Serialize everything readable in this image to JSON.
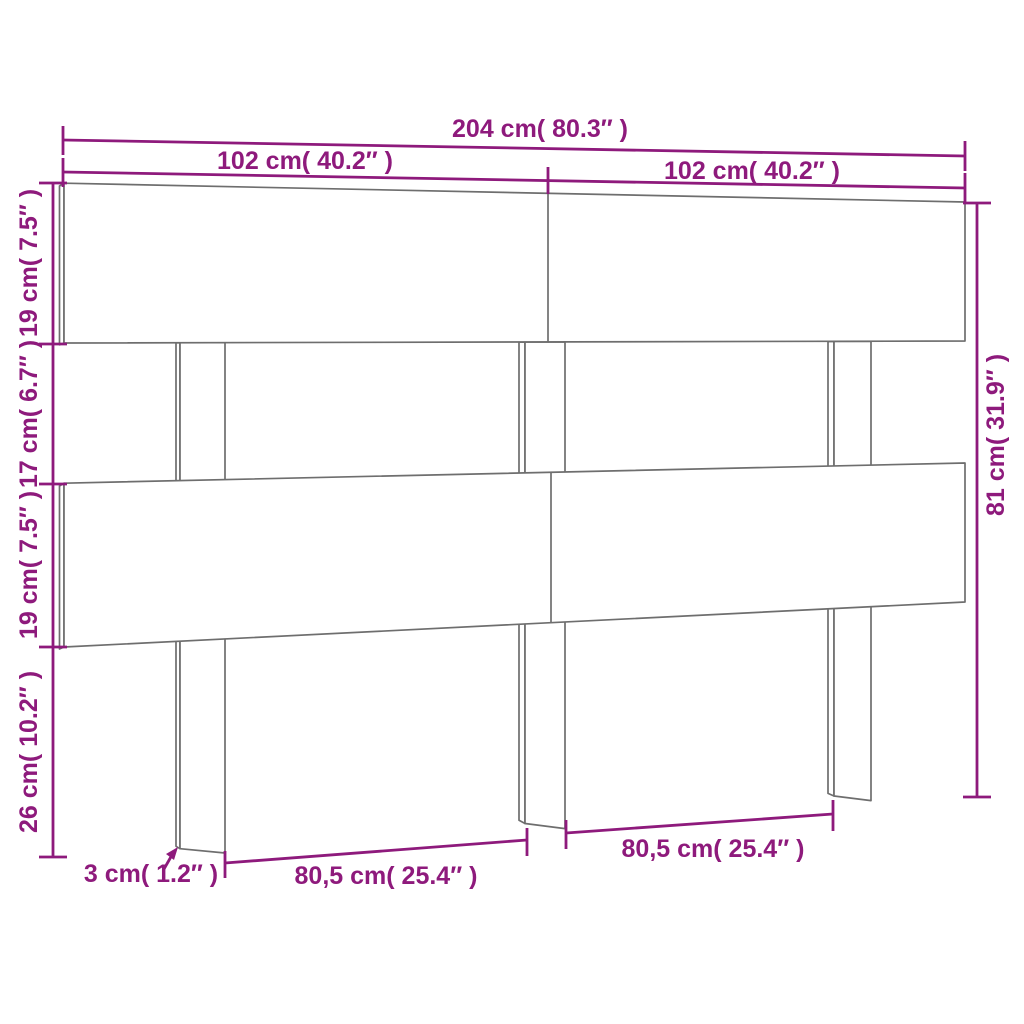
{
  "diagram": {
    "type": "product-dimension-diagram",
    "subject": "slatted headboard with three legs",
    "colors": {
      "dimension_annotation": "#8e1a7c",
      "product_outline": "#6e6e6e",
      "background": "#ffffff"
    },
    "labels": {
      "total_width": "204 cm( 80.3″ )",
      "left_half_width": "102 cm( 40.2″ )",
      "right_half_width": "102 cm( 40.2″ )",
      "top_board_height": "19 cm( 7.5″ )",
      "slat_gap_height": "17 cm( 6.7″ )",
      "lower_board_height": "19 cm( 7.5″ )",
      "leg_below_height": "26 cm( 10.2″ )",
      "total_height": "81 cm( 31.9″ )",
      "leg_thickness": "3 cm( 1.2″ )",
      "left_leg_spacing": "80,5 cm( 25.4″ )",
      "right_leg_spacing": "80,5 cm( 25.4″ )"
    }
  }
}
